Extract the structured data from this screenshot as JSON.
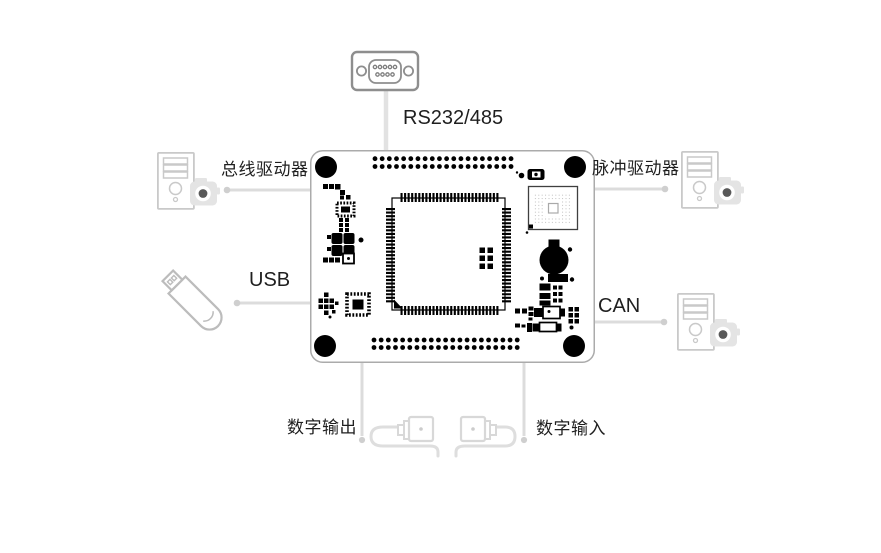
{
  "diagram": {
    "type": "hardware-connection-diagram",
    "labels": {
      "serial": "RS232/485",
      "bus_driver": "总线驱动器",
      "pulse_driver": "脉冲驱动器",
      "usb": "USB",
      "can": "CAN",
      "digital_output": "数字输出",
      "digital_input": "数字输入"
    },
    "nodes": [
      {
        "icon": "db9-serial-connector-icon",
        "label": "RS232/485",
        "position": "top"
      },
      {
        "icon": "pc-tower-camera-icon",
        "label": "总线驱动器",
        "position": "left-top"
      },
      {
        "icon": "pc-tower-camera-icon",
        "label": "脉冲驱动器",
        "position": "right-top"
      },
      {
        "icon": "usb-flash-drive-icon",
        "label": "USB",
        "position": "left-middle"
      },
      {
        "icon": "pc-tower-camera-icon",
        "label": "CAN",
        "position": "right-middle"
      },
      {
        "icon": "cable-plug-icon",
        "label": "数字输出",
        "position": "bottom-left"
      },
      {
        "icon": "cable-plug-icon",
        "label": "数字输入",
        "position": "bottom-right"
      },
      {
        "icon": "pcb-dev-board",
        "label": "",
        "position": "center"
      }
    ],
    "colors": {
      "text": "#1f1f1f",
      "connector_line": "#dcdcdc",
      "connector_dot": "#cfcfcf",
      "icon_outline": "#c9c9c9",
      "db9_outline": "#8e8e8e",
      "board_outline": "#ababab",
      "board_fill": "#ffffff",
      "component": "#000000",
      "camera_fill": "#e4e4e4",
      "camera_lens": "#595959",
      "background": "#ffffff"
    }
  }
}
